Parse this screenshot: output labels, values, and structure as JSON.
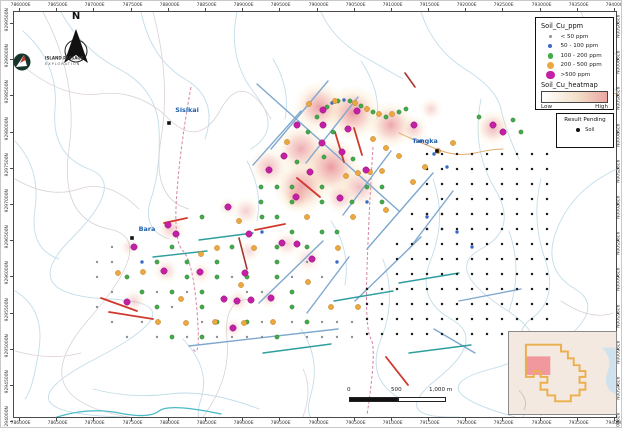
{
  "figure": {
    "type": "soil-geochemistry-map"
  },
  "north": {
    "label": "N"
  },
  "logo": {
    "line1": "ISLAND PASSAGE",
    "line2": "EXPLORATION"
  },
  "axes": {
    "eastings": [
      "786000E",
      "786500E",
      "787000E",
      "787500E",
      "788000E",
      "788500E",
      "789000E",
      "789500E",
      "790000E",
      "790500E",
      "791000E",
      "791500E",
      "792000E",
      "792500E",
      "793000E",
      "793500E",
      "794000E"
    ],
    "northings": [
      "9299500N",
      "9299000N",
      "9298500N",
      "9298000N",
      "9297500N",
      "9297000N",
      "9296500N",
      "9296000N",
      "9295500N",
      "9295000N",
      "9294500N",
      "9294000N"
    ]
  },
  "legend": {
    "title": "Soil_Cu_ppm",
    "items": [
      {
        "label": "< 50 ppm",
        "color": "#8d9298",
        "size": 3
      },
      {
        "label": "50 - 100 ppm",
        "color": "#3a6bc6",
        "size": 4
      },
      {
        "label": "100 - 200 ppm",
        "color": "#43ab4a",
        "size": 5.5
      },
      {
        "label": "200 - 500 ppm",
        "color": "#eda73f",
        "size": 7
      },
      {
        "label": ">500 ppm",
        "color": "#c420a6",
        "size": 8.5
      }
    ],
    "heatmap_title": "Soil_Cu_heatmap",
    "low": "Low",
    "high": "High",
    "heatmap_gradient": [
      "#ffffff",
      "#f3dfc9",
      "#eba6a4"
    ]
  },
  "pending": {
    "title": "Result Pending",
    "item_label": "Soil",
    "dot_color": "#111111"
  },
  "scalebar": {
    "labels": [
      "0",
      "500",
      "1,000 m"
    ]
  },
  "places": [
    {
      "name": "Sisikai",
      "x": 168,
      "y": 122,
      "lx": 186,
      "ly": 111
    },
    {
      "name": "Bara",
      "x": 131,
      "y": 237,
      "lx": 146,
      "ly": 230
    },
    {
      "name": "Tangka",
      "x": 436,
      "y": 150,
      "lx": 424,
      "ly": 142
    }
  ],
  "map": {
    "heat_blobs": [
      [
        318,
        106,
        26,
        0.85
      ],
      [
        352,
        112,
        28,
        0.9
      ],
      [
        390,
        124,
        24,
        0.8
      ],
      [
        300,
        148,
        26,
        0.75
      ],
      [
        330,
        166,
        30,
        0.9
      ],
      [
        300,
        186,
        28,
        0.85
      ],
      [
        358,
        186,
        22,
        0.6
      ],
      [
        268,
        166,
        20,
        0.6
      ],
      [
        413,
        128,
        14,
        0.5
      ],
      [
        492,
        127,
        18,
        0.65
      ],
      [
        430,
        108,
        12,
        0.4
      ],
      [
        245,
        210,
        15,
        0.45
      ],
      [
        170,
        228,
        14,
        0.5
      ],
      [
        248,
        250,
        12,
        0.35
      ],
      [
        286,
        243,
        14,
        0.4
      ],
      [
        165,
        270,
        13,
        0.45
      ],
      [
        200,
        272,
        12,
        0.35
      ],
      [
        133,
        300,
        12,
        0.4
      ],
      [
        237,
        300,
        12,
        0.4
      ],
      [
        268,
        297,
        11,
        0.35
      ],
      [
        128,
        246,
        10,
        0.3
      ],
      [
        307,
        258,
        15,
        0.35
      ],
      [
        232,
        327,
        11,
        0.35
      ],
      [
        339,
        197,
        16,
        0.5
      ],
      [
        295,
        196,
        14,
        0.5
      ],
      [
        227,
        206,
        10,
        0.35
      ]
    ],
    "dots": {
      "magenta": [
        [
          322,
          109
        ],
        [
          356,
          110
        ],
        [
          296,
          124
        ],
        [
          322,
          124
        ],
        [
          347,
          128
        ],
        [
          413,
          124
        ],
        [
          492,
          124
        ],
        [
          502,
          131
        ],
        [
          321,
          142
        ],
        [
          341,
          151
        ],
        [
          283,
          155
        ],
        [
          268,
          169
        ],
        [
          309,
          171
        ],
        [
          365,
          169
        ],
        [
          295,
          196
        ],
        [
          339,
          197
        ],
        [
          227,
          206
        ],
        [
          167,
          224
        ],
        [
          175,
          233
        ],
        [
          248,
          233
        ],
        [
          281,
          242
        ],
        [
          296,
          243
        ],
        [
          133,
          246
        ],
        [
          163,
          270
        ],
        [
          199,
          271
        ],
        [
          244,
          272
        ],
        [
          223,
          298
        ],
        [
          250,
          299
        ],
        [
          126,
          301
        ],
        [
          236,
          300
        ],
        [
          270,
          297
        ],
        [
          311,
          258
        ],
        [
          232,
          327
        ]
      ],
      "orange": [
        [
          308,
          103
        ],
        [
          334,
          100
        ],
        [
          354,
          102
        ],
        [
          366,
          108
        ],
        [
          378,
          113
        ],
        [
          391,
          113
        ],
        [
          286,
          141
        ],
        [
          372,
          138
        ],
        [
          385,
          147
        ],
        [
          398,
          155
        ],
        [
          345,
          175
        ],
        [
          357,
          172
        ],
        [
          369,
          171
        ],
        [
          381,
          170
        ],
        [
          306,
          216
        ],
        [
          352,
          216
        ],
        [
          238,
          220
        ],
        [
          216,
          247
        ],
        [
          253,
          247
        ],
        [
          200,
          253
        ],
        [
          142,
          271
        ],
        [
          117,
          272
        ],
        [
          240,
          284
        ],
        [
          180,
          298
        ],
        [
          307,
          281
        ],
        [
          157,
          321
        ],
        [
          185,
          322
        ],
        [
          214,
          321
        ],
        [
          243,
          322
        ],
        [
          272,
          321
        ],
        [
          330,
          306
        ],
        [
          357,
          306
        ],
        [
          385,
          209
        ],
        [
          412,
          181
        ],
        [
          424,
          166
        ],
        [
          437,
          150
        ],
        [
          452,
          142
        ],
        [
          337,
          247
        ]
      ],
      "green": [
        [
          316,
          116
        ],
        [
          326,
          106
        ],
        [
          337,
          100
        ],
        [
          349,
          100
        ],
        [
          360,
          105
        ],
        [
          372,
          111
        ],
        [
          385,
          116
        ],
        [
          398,
          111
        ],
        [
          405,
          108
        ],
        [
          478,
          116
        ],
        [
          512,
          119
        ],
        [
          520,
          131
        ],
        [
          307,
          131
        ],
        [
          332,
          131
        ],
        [
          296,
          161
        ],
        [
          323,
          156
        ],
        [
          352,
          158
        ],
        [
          260,
          186
        ],
        [
          276,
          186
        ],
        [
          291,
          186
        ],
        [
          321,
          186
        ],
        [
          366,
          186
        ],
        [
          381,
          186
        ],
        [
          260,
          201
        ],
        [
          291,
          201
        ],
        [
          321,
          201
        ],
        [
          351,
          201
        ],
        [
          381,
          201
        ],
        [
          201,
          216
        ],
        [
          261,
          216
        ],
        [
          276,
          216
        ],
        [
          291,
          231
        ],
        [
          321,
          231
        ],
        [
          336,
          231
        ],
        [
          171,
          246
        ],
        [
          231,
          246
        ],
        [
          276,
          246
        ],
        [
          306,
          246
        ],
        [
          156,
          261
        ],
        [
          186,
          261
        ],
        [
          216,
          261
        ],
        [
          276,
          261
        ],
        [
          126,
          276
        ],
        [
          186,
          276
        ],
        [
          216,
          276
        ],
        [
          246,
          276
        ],
        [
          276,
          276
        ],
        [
          141,
          291
        ],
        [
          171,
          291
        ],
        [
          201,
          291
        ],
        [
          291,
          291
        ],
        [
          156,
          306
        ],
        [
          201,
          306
        ],
        [
          291,
          306
        ],
        [
          216,
          321
        ],
        [
          246,
          321
        ],
        [
          171,
          336
        ],
        [
          201,
          336
        ],
        [
          276,
          336
        ],
        [
          306,
          321
        ]
      ],
      "blue": [
        [
          331,
          102
        ],
        [
          343,
          99
        ],
        [
          420,
          140
        ],
        [
          433,
          153
        ],
        [
          446,
          166
        ],
        [
          366,
          201
        ],
        [
          426,
          216
        ],
        [
          456,
          231
        ],
        [
          471,
          246
        ],
        [
          336,
          261
        ],
        [
          261,
          231
        ],
        [
          141,
          261
        ]
      ],
      "gray": [
        [
          111,
          261
        ],
        [
          96,
          276
        ],
        [
          111,
          291
        ],
        [
          96,
          306
        ],
        [
          111,
          321
        ],
        [
          126,
          336
        ],
        [
          141,
          321
        ],
        [
          156,
          336
        ],
        [
          186,
          336
        ],
        [
          111,
          246
        ],
        [
          96,
          261
        ],
        [
          156,
          291
        ],
        [
          171,
          306
        ],
        [
          186,
          291
        ],
        [
          201,
          321
        ],
        [
          216,
          336
        ],
        [
          246,
          336
        ],
        [
          261,
          321
        ],
        [
          291,
          321
        ],
        [
          306,
          336
        ],
        [
          321,
          321
        ],
        [
          336,
          321
        ],
        [
          351,
          321
        ],
        [
          336,
          336
        ],
        [
          351,
          336
        ],
        [
          246,
          291
        ],
        [
          231,
          276
        ],
        [
          306,
          261
        ],
        [
          321,
          276
        ],
        [
          291,
          276
        ],
        [
          261,
          291
        ],
        [
          231,
          336
        ],
        [
          261,
          336
        ],
        [
          321,
          336
        ]
      ]
    },
    "pending_grids": [
      {
        "x0": 426,
        "y0": 153,
        "cols": 9,
        "rows": 6,
        "step": 15
      },
      {
        "x0": 411,
        "y0": 213,
        "cols": 3,
        "rows": 2,
        "step": 15
      },
      {
        "x0": 396,
        "y0": 243,
        "cols": 11,
        "rows": 3,
        "step": 15
      },
      {
        "x0": 366,
        "y0": 288,
        "cols": 13,
        "rows": 4,
        "step": 15
      }
    ],
    "streams": [
      "M22,30 Q58,62 54,108 T88,168 T70,238 T108,298 T94,358 T128,416",
      "M60,11 Q80,48 118,68 T158,128 T150,198 T168,238",
      "M140,11 Q150,58 184,78 T204,138",
      "M236,11 Q226,58 254,93 T250,148",
      "M320,11 Q332,38 360,54 T402,78",
      "M420,11 Q432,48 464,68 T500,108 T518,158",
      "M544,20 Q558,58 598,78 T616,128",
      "M616,168 Q572,188 556,228 T574,288 T552,348",
      "M480,98 Q470,148 494,188 T480,248 T504,308 T490,368 T514,416",
      "M432,178 Q446,218 430,258 T450,318 T436,378 T458,416",
      "M382,258 Q396,298 380,338 T400,398",
      "M300,328 Q320,358 310,393 T330,416",
      "M182,338 Q210,368 200,398 T214,416",
      "M92,388 Q130,398 168,393 T258,408",
      "M540,178 Q530,218 544,258 T530,318 T554,378",
      "M272,58 Q290,88 284,118",
      "M580,11 Q590,38 616,54",
      "M14,140 Q40,168 34,208 T58,258",
      "M14,290 Q44,308 38,348 T24,398",
      "M360,60 Q380,90 376,118",
      "M508,230 Q522,270 508,310",
      "M246,160 Q262,190 256,220",
      "M330,220 Q350,250 344,284"
    ],
    "streams_teal": [
      "M56,416 Q88,406 118,412 T158,410 T220,413"
    ],
    "tracks": [
      "M42,11 Q78,78 68,148 T108,228 T88,318 T128,416",
      "M14,58 Q58,98 98,93 T168,118 T220,108 T270,118",
      "M152,11 Q170,78 160,138 T188,208",
      "M14,178 Q48,198 78,188 T138,208",
      "M202,416 Q230,378 226,338 T250,298",
      "M522,416 Q540,388 530,358",
      "M302,416 Q312,388 302,368",
      "M14,350 Q50,360 80,352",
      "M560,300 Q590,320 612,312"
    ],
    "roads": [
      "M398,132 Q420,142 438,149 T474,152 T502,148",
      "M616,92 Q592,100 574,94",
      "M540,414 Q562,400 588,403"
    ],
    "dashed_tracks": [
      "M190,86 Q180,140 176,190 T182,250 T196,310 T192,348",
      "M372,146 Q368,208 366,268 T370,338 T366,414"
    ],
    "segments": {
      "steel": [
        [
          256,
          83,
          398,
          210
        ],
        [
          327,
          80,
          270,
          148
        ],
        [
          357,
          96,
          305,
          162
        ],
        [
          390,
          150,
          342,
          214
        ],
        [
          432,
          172,
          366,
          248
        ],
        [
          300,
          110,
          252,
          164
        ],
        [
          322,
          240,
          258,
          302
        ],
        [
          348,
          256,
          306,
          312
        ],
        [
          420,
          236,
          354,
          300
        ],
        [
          452,
          190,
          408,
          248
        ],
        [
          188,
          345,
          337,
          328
        ],
        [
          458,
          300,
          520,
          288
        ],
        [
          433,
          328,
          474,
          352
        ]
      ],
      "teal": [
        [
          198,
          239,
          252,
          232
        ],
        [
          333,
          300,
          392,
          290
        ],
        [
          398,
          282,
          458,
          272
        ],
        [
          262,
          352,
          330,
          343
        ],
        [
          152,
          256,
          206,
          250
        ],
        [
          408,
          352,
          470,
          344
        ]
      ],
      "red": [
        [
          334,
          131,
          343,
          161
        ],
        [
          353,
          127,
          361,
          154
        ],
        [
          296,
          177,
          319,
          196
        ],
        [
          100,
          297,
          136,
          310
        ],
        [
          108,
          311,
          152,
          318
        ],
        [
          254,
          229,
          284,
          223
        ],
        [
          385,
          356,
          407,
          384
        ],
        [
          163,
          222,
          186,
          217
        ]
      ],
      "darkred": [
        [
          238,
          237,
          246,
          268
        ],
        [
          404,
          72,
          414,
          86
        ]
      ]
    }
  },
  "inset": {
    "background": "#f3e9e1",
    "tenement_color": "#ecaf4e",
    "extent_color": "#ef8f96",
    "water_color": "#cfe2ee"
  }
}
